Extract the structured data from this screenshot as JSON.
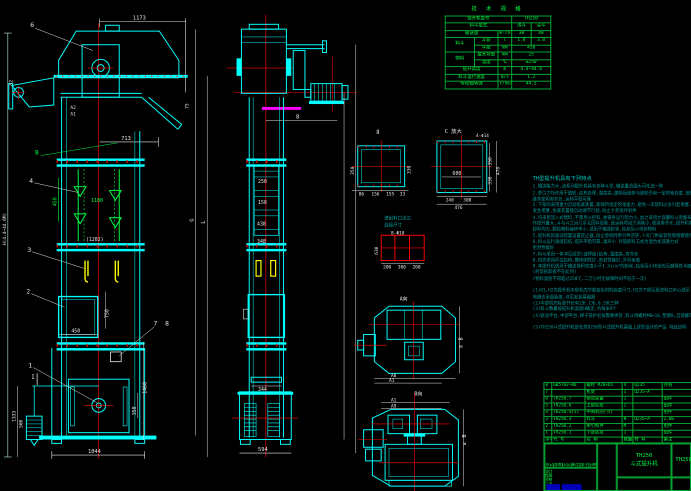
{
  "drawing": {
    "product_model": "TH250",
    "product_name": "斗式提升机",
    "drawing_no": "TH250.0"
  },
  "spec_table": {
    "title": "技 术 规 格",
    "rows": [
      [
        {
          "t": "提升机型号",
          "cs": 3
        },
        {
          "t": "TH250",
          "cs": 2
        }
      ],
      [
        {
          "t": "料斗型式",
          "cs": 3
        },
        {
          "t": "浅斗"
        },
        {
          "t": "深斗"
        }
      ],
      [
        {
          "t": "输送量",
          "cs": 2
        },
        {
          "t": "m³/h"
        },
        {
          "t": "30"
        },
        {
          "t": "48"
        }
      ],
      [
        {
          "t": "料斗",
          "rs": 2
        },
        {
          "t": "斗容"
        },
        {
          "t": "l"
        },
        {
          "t": "1.8"
        },
        {
          "t": "3.0"
        }
      ],
      [
        {
          "t": "斗距"
        },
        {
          "t": "mm"
        },
        {
          "t": "450",
          "cs": 2
        }
      ],
      [
        {
          "t": "物料",
          "rs": 2
        },
        {
          "t": "最大块度"
        },
        {
          "t": "mm"
        },
        {
          "t": "25",
          "cs": 2
        }
      ],
      [
        {
          "t": "温度"
        },
        {
          "t": "℃"
        },
        {
          "t": "≤250",
          "cs": 2
        }
      ],
      [
        {
          "t": "提升高度",
          "cs": 2
        },
        {
          "t": "m"
        },
        {
          "t": "4.4~44.6",
          "cs": 2
        }
      ],
      [
        {
          "t": "料斗运行速度",
          "cs": 2
        },
        {
          "t": "m/s"
        },
        {
          "t": "1.2",
          "cs": 2
        }
      ],
      [
        {
          "t": "传动轴转速",
          "cs": 2
        },
        {
          "t": "r/min"
        },
        {
          "t": "44.5",
          "cs": 2
        }
      ]
    ]
  },
  "notes": {
    "title": "TH型提升机具有下列特点",
    "lines": [
      "1.输送能力大,该系列提升机具有多种斗型,输送量范围大可任选一种",
      "2.牵引力均作用于链轮,结构合理,强度高,磨损后链条与链轮仍有一定的啮合度,故传动",
      "  链条使用寿命长,运转平稳可靠",
      "3.下部均采用重力自动张紧装置,能保持恒定的张紧力,避免一次装料过多引起堵塞,万一",
      "  发生堵塞,张紧装置能自动调节行程,防止卡死损坏机件",
      "4.均采用流入式喂料,不需用斗挖料,故链条运行阻力小,加之采用大容量料斗密集布置,工",
      "  作提升量大,斗与斗之间几乎无回料现象,故运转时动力消耗小,使用寿命长,提升机喂料",
      "  卸料均匀,颗粒物料破碎率小,适用于输送粉状,粒状及小块状物料",
      "5.提升机的驱动装置设置逆止器,防止停机时牵引件逆转,人孔门供安装检修观察使用,任选",
      "6.料斗运行速度较低,提升平稳可靠,噪声小      环链卸料方式为混合式或重力式",
      "  密封性能好",
      "7.料斗采用一体冲压成型(或焊接)结构,强度高,寿命长",
      "8.机壳采用折边结构,整体刚性好,密封性能好,外形美观",
      "9.本提升机适用于输送堆积密度小于1.5t/m³的粉状,粒状及小块状的无磨琢性半磨琢性物料",
      "  (经常拆卸者不在此列)",
      "  (物料温度不得超过250℃,二万小时无故障时间不低于一次)",
      "",
      "(1)H1,H2为提升机中部机壳节数变化时的高度尺寸,H2为下部区段进料口中心线至",
      "  地脚支承面距离,详见安装基础图",
      "(2)中部机壳标准节长有2米,1米,0.5米三种",
      "(3)料斗数量按提升机高度H确定,约每米9个",
      "(4)驱动平台,中部平台,梯子及护栏按需要供货,料斗用螺栓M8×16,垫圈8,自锁螺母M8连接",
      "",
      "(5)TH250斗式提升机是在原D250型斗式提升机基础上改型设计的产品 特此说明"
    ]
  },
  "bom": {
    "headers": [
      "序号",
      "代  号",
      "名  称",
      "数量",
      "材  料",
      "备注"
    ],
    "rows": [
      [
        "8",
        "GB5782—86",
        "螺栓 M20×65",
        "4",
        "Q235",
        "外购"
      ],
      [
        "7",
        "",
        "机架",
        "1",
        "Q235—A",
        ""
      ],
      [
        "6",
        "TH250.7",
        "驱动装置",
        "1",
        "",
        "组件"
      ],
      [
        "5",
        "TH250.6",
        "上部区段",
        "1",
        "",
        "组件"
      ],
      [
        "4",
        "TH250.4(5)",
        "中间机壳(节)",
        "",
        "",
        "组件"
      ],
      [
        "3",
        "TH250.3",
        "料斗",
        "N",
        "Q235—A",
        "2.06"
      ],
      [
        "2",
        "TH250.2",
        "牵引构件",
        "M",
        "",
        "组件"
      ],
      [
        "1",
        "TH250.1",
        "下部区段",
        "1",
        "",
        "组件"
      ]
    ]
  },
  "title_block": {
    "model": "TH250",
    "name": "斗式提升机",
    "drawing_no": "TH250.0",
    "row_labels": [
      "标记",
      "处数",
      "分区",
      "更改文件号",
      "签字",
      "日期"
    ],
    "sign_labels": [
      "设计",
      "绘图",
      "审核",
      "工艺"
    ]
  },
  "art": {
    "front": {
      "d1173": "1173",
      "d713": "713",
      "d52": "52",
      "dA2": "A2",
      "dA1": "A1",
      "d75": "75",
      "d1180": "1180",
      "d450g": "450",
      "d1202": "(1202)",
      "d750": "750",
      "d450": "450",
      "d1460": "1460",
      "d350": "350",
      "d1333": "1333",
      "d500": "500",
      "d1044": "1044",
      "dG": "G",
      "dL": "L",
      "dH": "H(4.4~44.6M)",
      "dB": "B",
      "secI": "I",
      "b1": "1",
      "b2": "2",
      "b3": "3",
      "b4": "4",
      "b6": "6",
      "b7": "7",
      "b8": "8"
    },
    "side": {
      "dB": "B",
      "d250": "250",
      "d150": "150",
      "d438": "438",
      "d348": "348",
      "d344": "344",
      "d594": "594"
    },
    "det2": {
      "label": "Ⅱ",
      "dl": "350",
      "dr": "330",
      "b1": "86",
      "b2": "156",
      "b3": "155",
      "b4": "33"
    },
    "detC": {
      "label": "C 放大",
      "holes": "4-Φ14",
      "d600": "600",
      "r1": "350",
      "r2": "330",
      "r3": "478",
      "b1": "240",
      "b2": "300",
      "b3": "476"
    },
    "detR": {
      "t1": "进出料口法兰",
      "t2": "连接尺寸",
      "holes": "8-Φ18",
      "dv": "630",
      "b1": "200",
      "b2": "300",
      "b3": "200"
    },
    "plat": {
      "a8": "A8",
      "a1": "A1",
      "dir": "A向",
      "B": "B",
      "a": "a"
    },
    "plat2": {
      "a1": "A1",
      "a9": "A9",
      "dir": "B向",
      "B": "B",
      "a": "a"
    }
  },
  "colors": {
    "machine": "#00ffff",
    "dims_white": "#e8e8e8",
    "dims_green": "#00ff44",
    "centerline": "#ff0000",
    "guide": "#ffff00",
    "coupling": "#ff00ff",
    "notes": "#009f9f"
  }
}
